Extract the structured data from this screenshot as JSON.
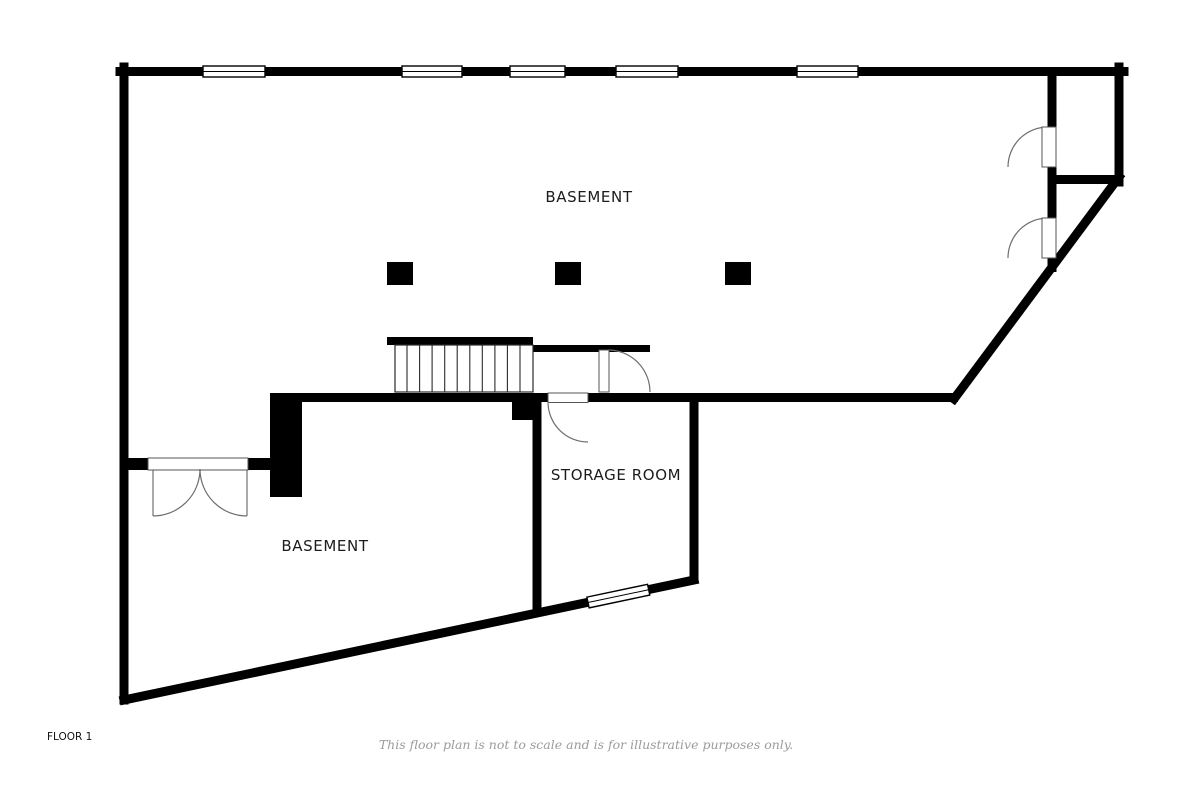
{
  "page": {
    "background_color": "#ffffff",
    "wall_color": "#000000",
    "door_line_color": "#6e6e6e",
    "label_color": "#1c1c1c",
    "muted_text_color": "#9b9b9b"
  },
  "floor_plan": {
    "floor_label": "FLOOR 1",
    "disclaimer": "This floor plan is not to scale and is for illustrative purposes only.",
    "rooms": [
      {
        "id": "basement-upper",
        "label": "BASEMENT"
      },
      {
        "id": "basement-lower",
        "label": "BASEMENT"
      },
      {
        "id": "storage-room",
        "label": "STORAGE ROOM"
      }
    ],
    "features": {
      "top_wall_windows": 5,
      "diagonal_wall_windows": 1,
      "single_doors": 5,
      "double_doors": 1,
      "columns": 3,
      "staircases": 1
    }
  }
}
